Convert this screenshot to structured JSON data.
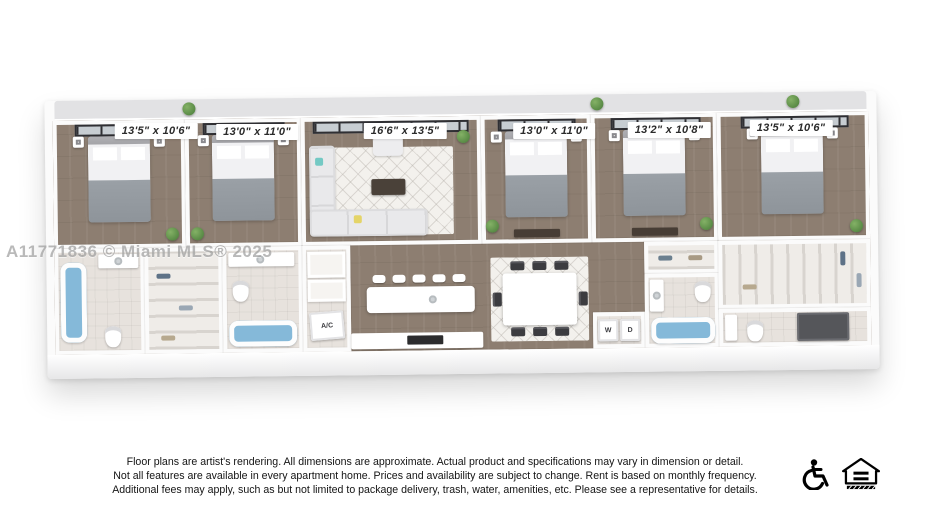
{
  "page": {
    "background": "#ffffff"
  },
  "floorplan": {
    "room_labels": [
      "13'5\" x 10'6\"",
      "13'0\" x 11'0\"",
      "16'6\" x 13'5\"",
      "13'0\" x 11'0\"",
      "13'2\" x 10'8\"",
      "13'5\" x 10'6\""
    ],
    "appliance_labels": {
      "washer": "W",
      "dryer": "D",
      "ac": "A/C"
    },
    "colors": {
      "wood_floor": "#8d7e71",
      "tile_floor": "#e7e2dd",
      "wall": "#fbfbfb",
      "window_frame": "#2f2f33",
      "bath_water": "#85b9d9",
      "terrace": "#e2e2e4",
      "sofa": "#e9e9eb",
      "accent_teal": "#74c9c4",
      "accent_yellow": "#e4d468"
    }
  },
  "watermark": {
    "text": "A11771836 © Miami MLS® 2025"
  },
  "footer": {
    "lines": [
      "Floor plans are artist's rendering. All dimensions are approximate. Actual product and specifications may vary in dimension or detail.",
      "Not all features are available in every apartment home. Prices and availability are subject to change. Rent is based on monthly frequency.",
      "Additional fees may apply, such as but not limited to package delivery, trash, water, amenities, etc. Please see a representative for details."
    ],
    "icons": [
      "accessibility-icon",
      "equal-housing-icon"
    ]
  }
}
